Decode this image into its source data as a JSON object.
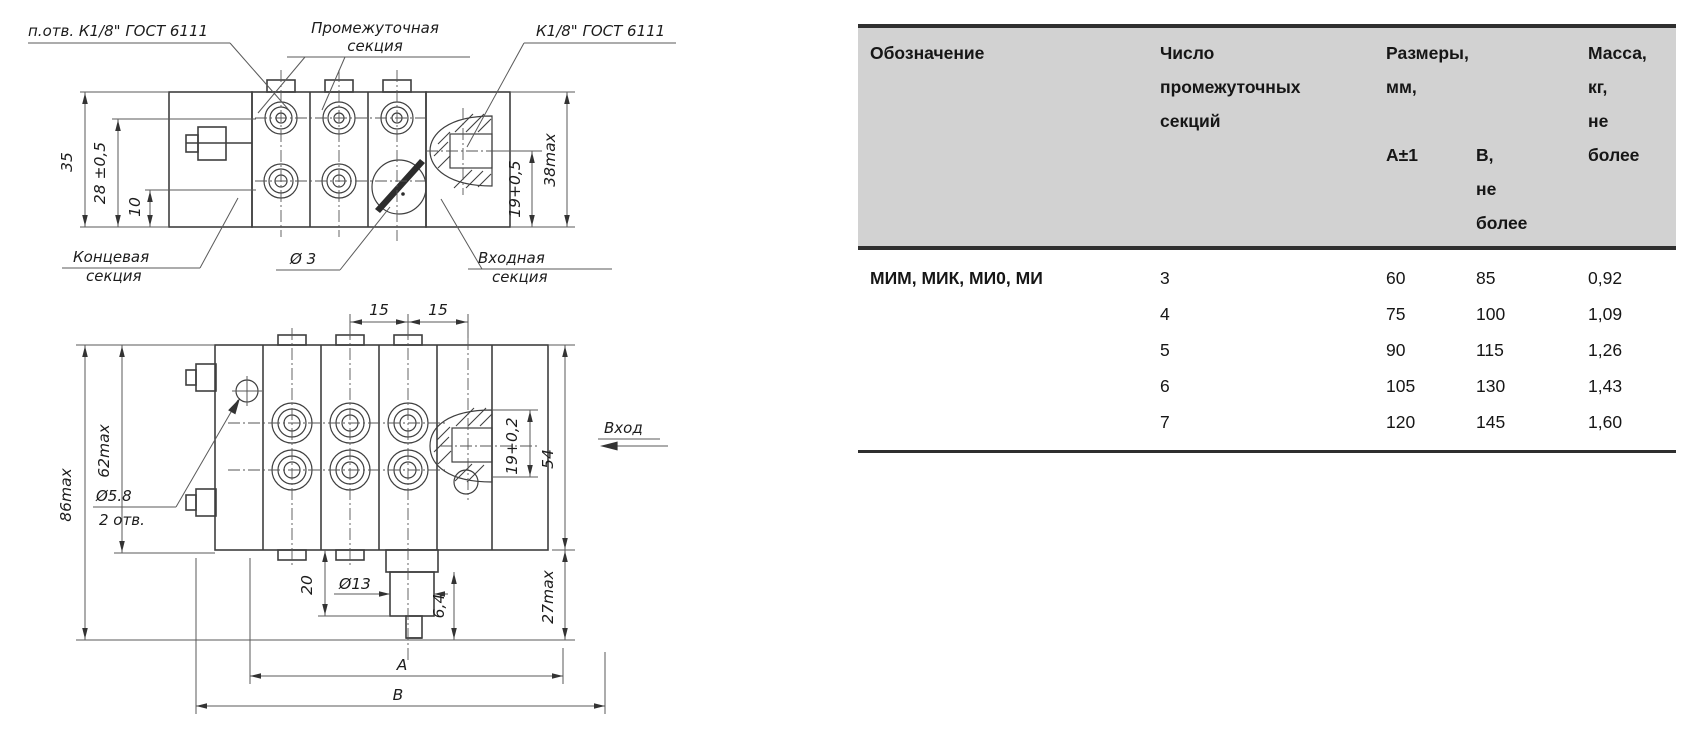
{
  "colors": {
    "header_bg": "#d2d2d2",
    "line": "#3f3f3f",
    "text": "#161616"
  },
  "drawing": {
    "top_view": {
      "hole_note": "п.отв. К1/8\" ГОСТ 6111",
      "intermediate_line1": "Промежуточная",
      "intermediate_line2": "секция",
      "thread_note": "К1/8\" ГОСТ 6111",
      "end_line1": "Концевая",
      "end_line2": "секция",
      "orifice": "Ø 3",
      "inlet_line1": "Входная",
      "inlet_line2": "секция",
      "dim_height": "35",
      "dim_28": "28 ±0,5",
      "dim_10": "10",
      "dim_19": "19+0,5",
      "dim_38": "38max"
    },
    "front_view": {
      "dim_15_left": "15",
      "dim_15_right": "15",
      "dim_86": "86max",
      "dim_62": "62max",
      "holes_line1": "Ø5.8",
      "holes_line2": "2 отв.",
      "dim_19": "19+0,2",
      "dim_54": "54",
      "inlet_arrow_label": "Вход",
      "dim_20": "20",
      "dim_13": "Ø13",
      "dim_6_4": "6,4",
      "dim_27": "27max",
      "dim_a": "A",
      "dim_b": "B"
    }
  },
  "table": {
    "header": {
      "designation": "Обозначение",
      "sections": "Число\nпромежуточных\nсекций",
      "sizes": "Размеры,\nмм,",
      "sub_a": "А±1",
      "sub_b": "В,\nне\nболее",
      "mass": "Масса,\nкг,\nне\nболее"
    },
    "designation_value": "МИМ, МИК, МИ0, МИ",
    "rows": [
      {
        "sections": "3",
        "a": "60",
        "b": "85",
        "mass": "0,92"
      },
      {
        "sections": "4",
        "a": "75",
        "b": "100",
        "mass": "1,09"
      },
      {
        "sections": "5",
        "a": "90",
        "b": "115",
        "mass": "1,26"
      },
      {
        "sections": "6",
        "a": "105",
        "b": "130",
        "mass": "1,43"
      },
      {
        "sections": "7",
        "a": "120",
        "b": "145",
        "mass": "1,60"
      }
    ]
  }
}
